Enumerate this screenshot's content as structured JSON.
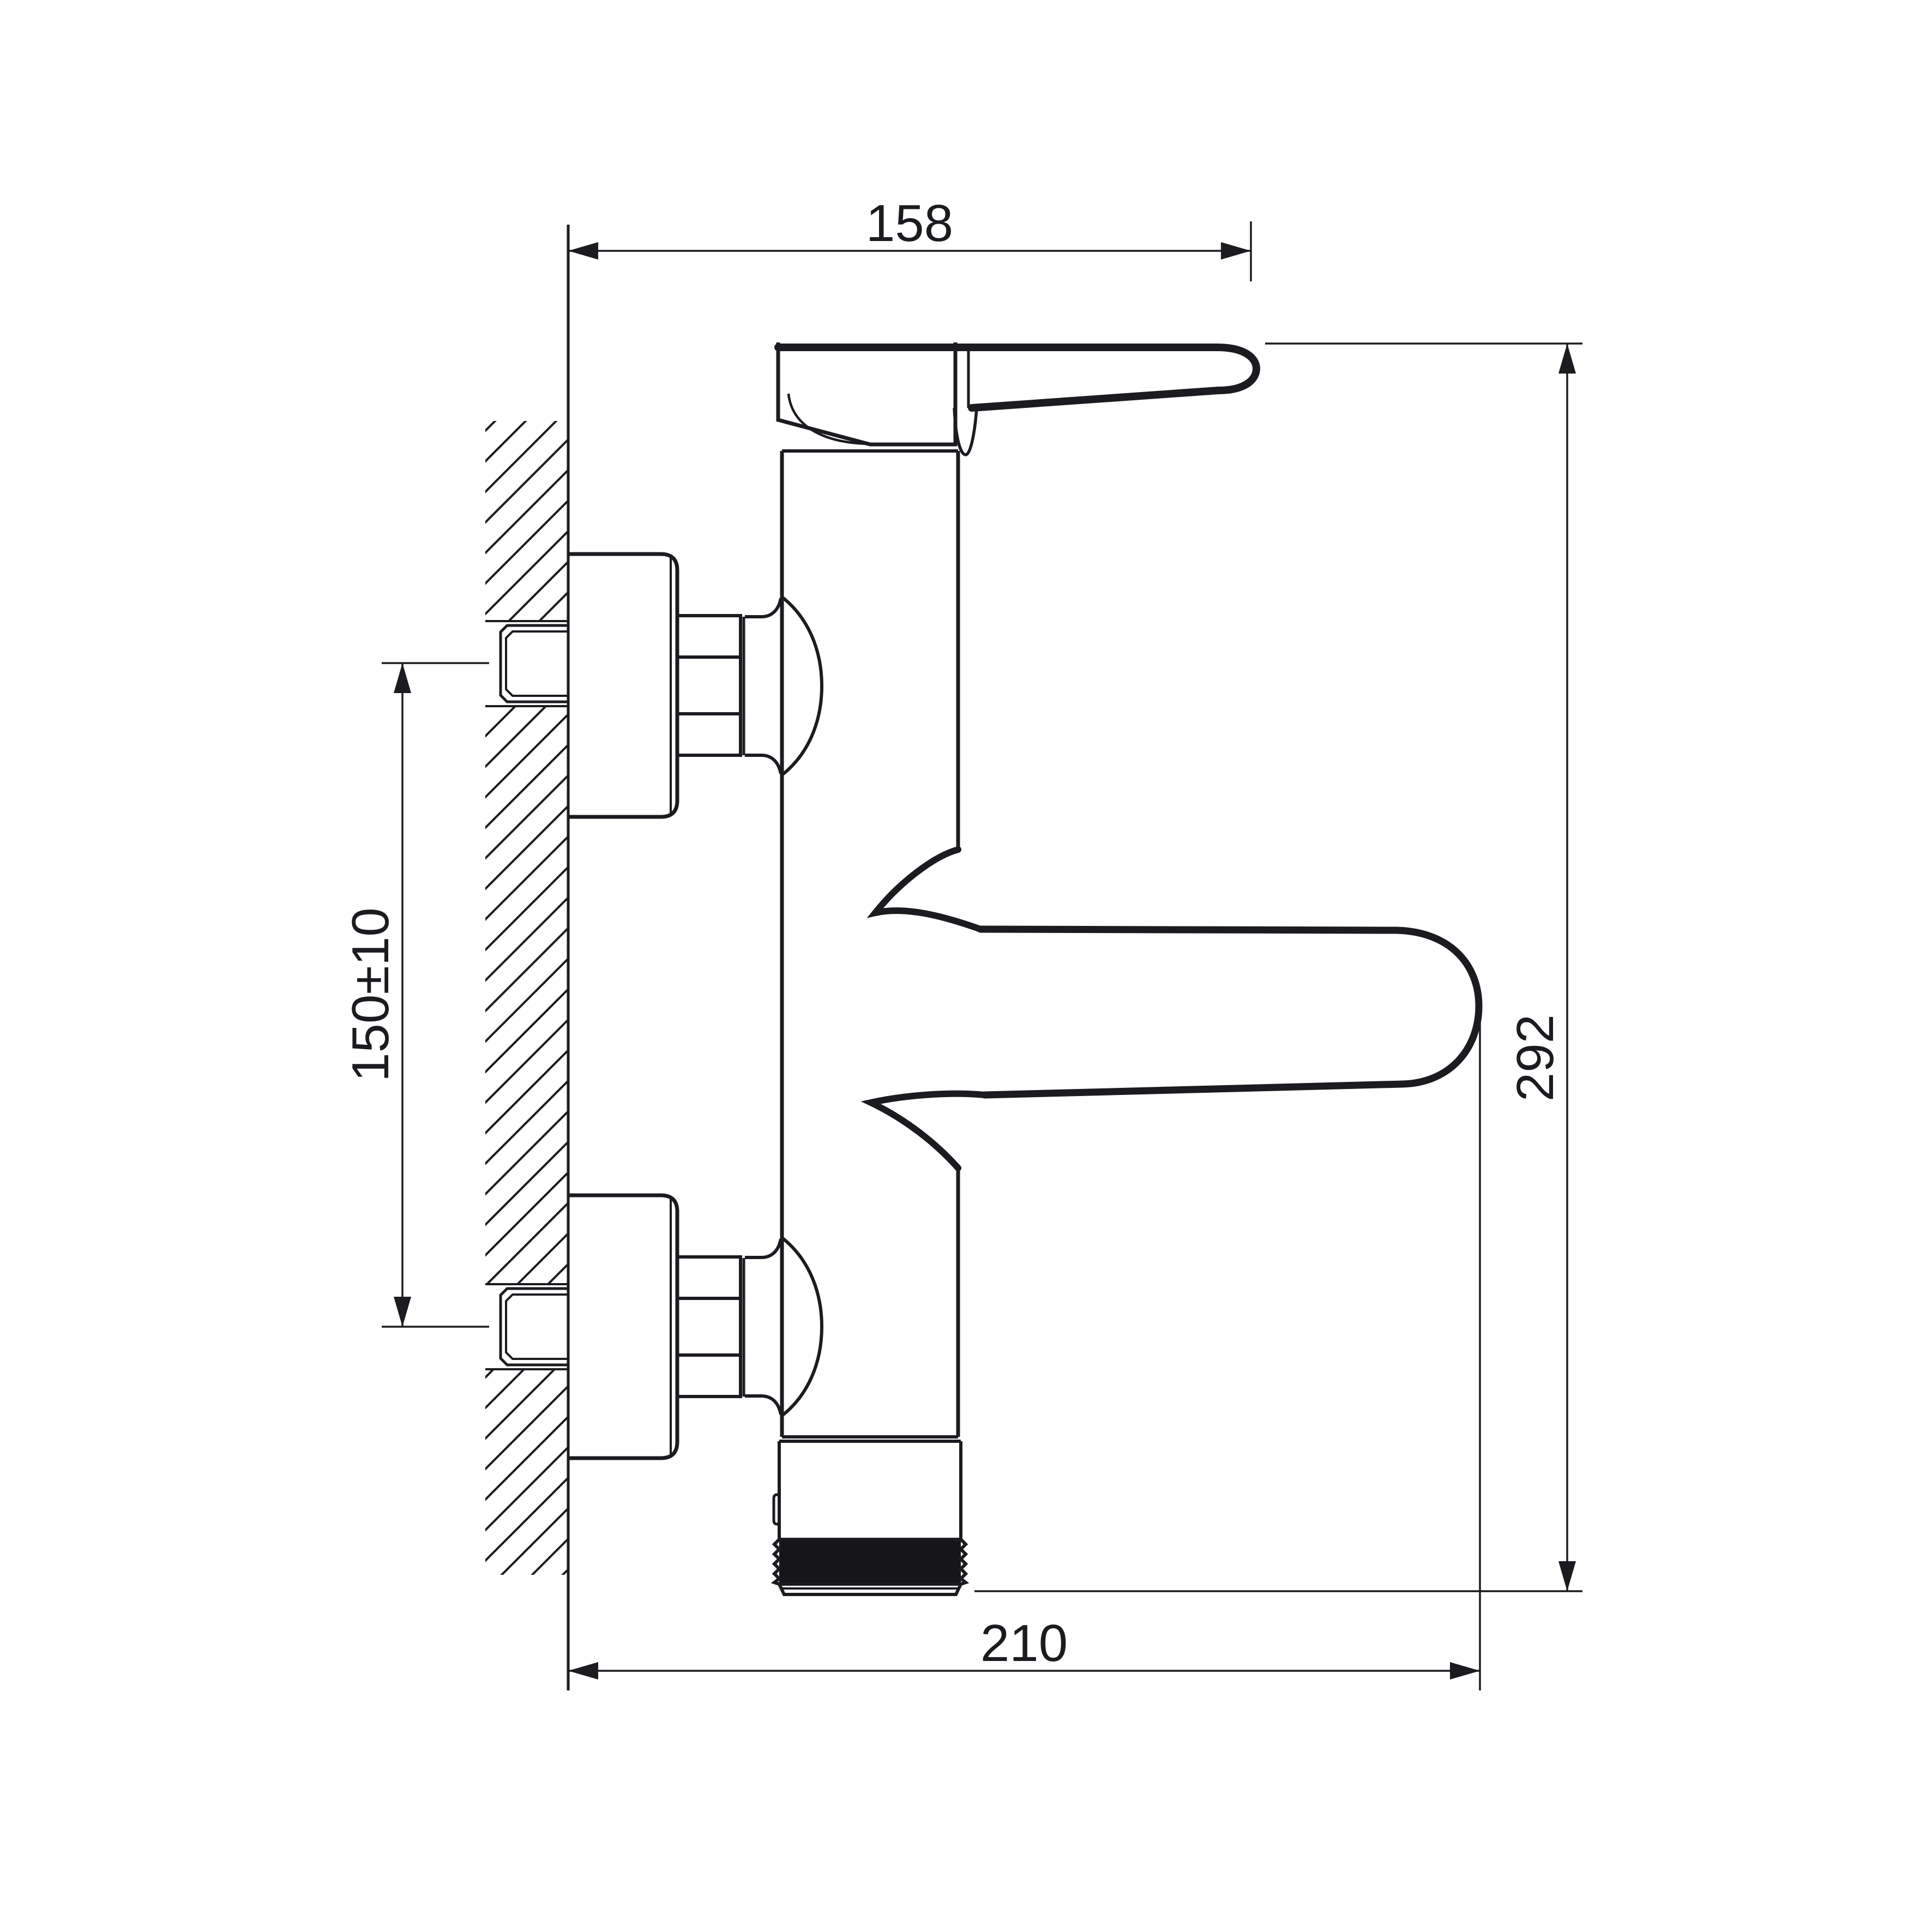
{
  "drawing": {
    "kind": "faucet-installation-technical-drawing",
    "colors": {
      "paper": "#ffffff",
      "ink": "#1b1b20",
      "thread_fill": "#15151a"
    },
    "dimensions": {
      "top_width": {
        "value": "158",
        "orientation": "horizontal",
        "location": "top"
      },
      "right_height": {
        "value": "292",
        "orientation": "vertical",
        "location": "right"
      },
      "left_inlet_spacing": {
        "value": "150±10",
        "orientation": "vertical",
        "location": "left"
      },
      "bottom_depth": {
        "value": "210",
        "orientation": "horizontal",
        "location": "bottom"
      }
    }
  }
}
